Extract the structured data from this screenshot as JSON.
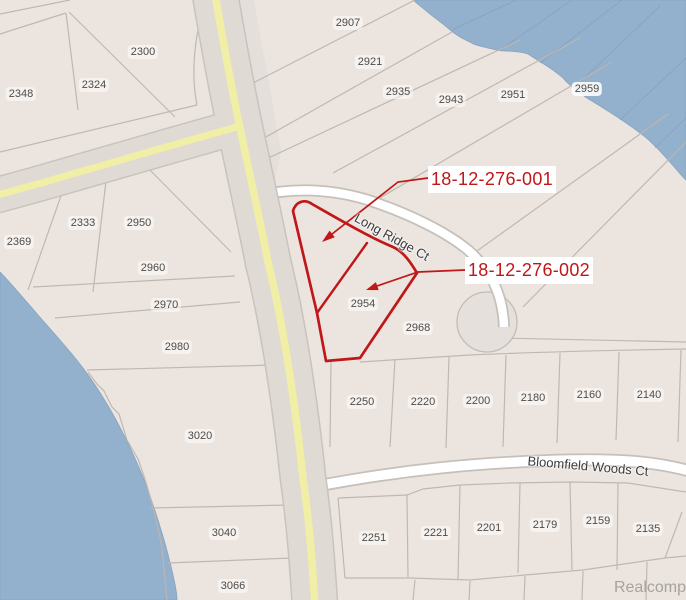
{
  "map": {
    "watermark": "Realcomp",
    "street_labels": [
      {
        "name": "Long Ridge Ct"
      },
      {
        "name": "Bloomfield Woods Ct"
      }
    ],
    "callouts": [
      {
        "parcel_id": "18-12-276-001"
      },
      {
        "parcel_id": "18-12-276-002"
      }
    ],
    "parcels": [
      {
        "number": "2300",
        "x": 143,
        "y": 52
      },
      {
        "number": "2324",
        "x": 94,
        "y": 85
      },
      {
        "number": "2348",
        "x": 21,
        "y": 94
      },
      {
        "number": "2369",
        "x": 19,
        "y": 242
      },
      {
        "number": "2333",
        "x": 83,
        "y": 223
      },
      {
        "number": "2950",
        "x": 139,
        "y": 223
      },
      {
        "number": "2960",
        "x": 153,
        "y": 268
      },
      {
        "number": "2970",
        "x": 166,
        "y": 305
      },
      {
        "number": "2980",
        "x": 177,
        "y": 347
      },
      {
        "number": "3020",
        "x": 200,
        "y": 436
      },
      {
        "number": "3040",
        "x": 224,
        "y": 533
      },
      {
        "number": "3066",
        "x": 233,
        "y": 586
      },
      {
        "number": "2907",
        "x": 348,
        "y": 23
      },
      {
        "number": "2921",
        "x": 370,
        "y": 62
      },
      {
        "number": "2935",
        "x": 398,
        "y": 92
      },
      {
        "number": "2943",
        "x": 451,
        "y": 100
      },
      {
        "number": "2951",
        "x": 513,
        "y": 95
      },
      {
        "number": "2959",
        "x": 587,
        "y": 89,
        "pill": true
      },
      {
        "number": "2954",
        "x": 363,
        "y": 304
      },
      {
        "number": "2968",
        "x": 418,
        "y": 328
      },
      {
        "number": "2250",
        "x": 362,
        "y": 402
      },
      {
        "number": "2220",
        "x": 423,
        "y": 402
      },
      {
        "number": "2200",
        "x": 478,
        "y": 401
      },
      {
        "number": "2180",
        "x": 533,
        "y": 398
      },
      {
        "number": "2160",
        "x": 589,
        "y": 395
      },
      {
        "number": "2140",
        "x": 649,
        "y": 395
      },
      {
        "number": "2251",
        "x": 374,
        "y": 538
      },
      {
        "number": "2221",
        "x": 436,
        "y": 533
      },
      {
        "number": "2201",
        "x": 489,
        "y": 528
      },
      {
        "number": "2179",
        "x": 545,
        "y": 525
      },
      {
        "number": "2159",
        "x": 598,
        "y": 521
      },
      {
        "number": "2135",
        "x": 648,
        "y": 529
      }
    ],
    "colors": {
      "water": "#93B1CC",
      "land": "#ECE5DF",
      "road_fill": "#DFDAD4",
      "road_stripe": "#F1EEA6",
      "road_white": "#FFFFFF",
      "lot_line": "#BDB6B0",
      "highlight_red": "#C01718",
      "parcel_text": "#4E4B48"
    }
  }
}
